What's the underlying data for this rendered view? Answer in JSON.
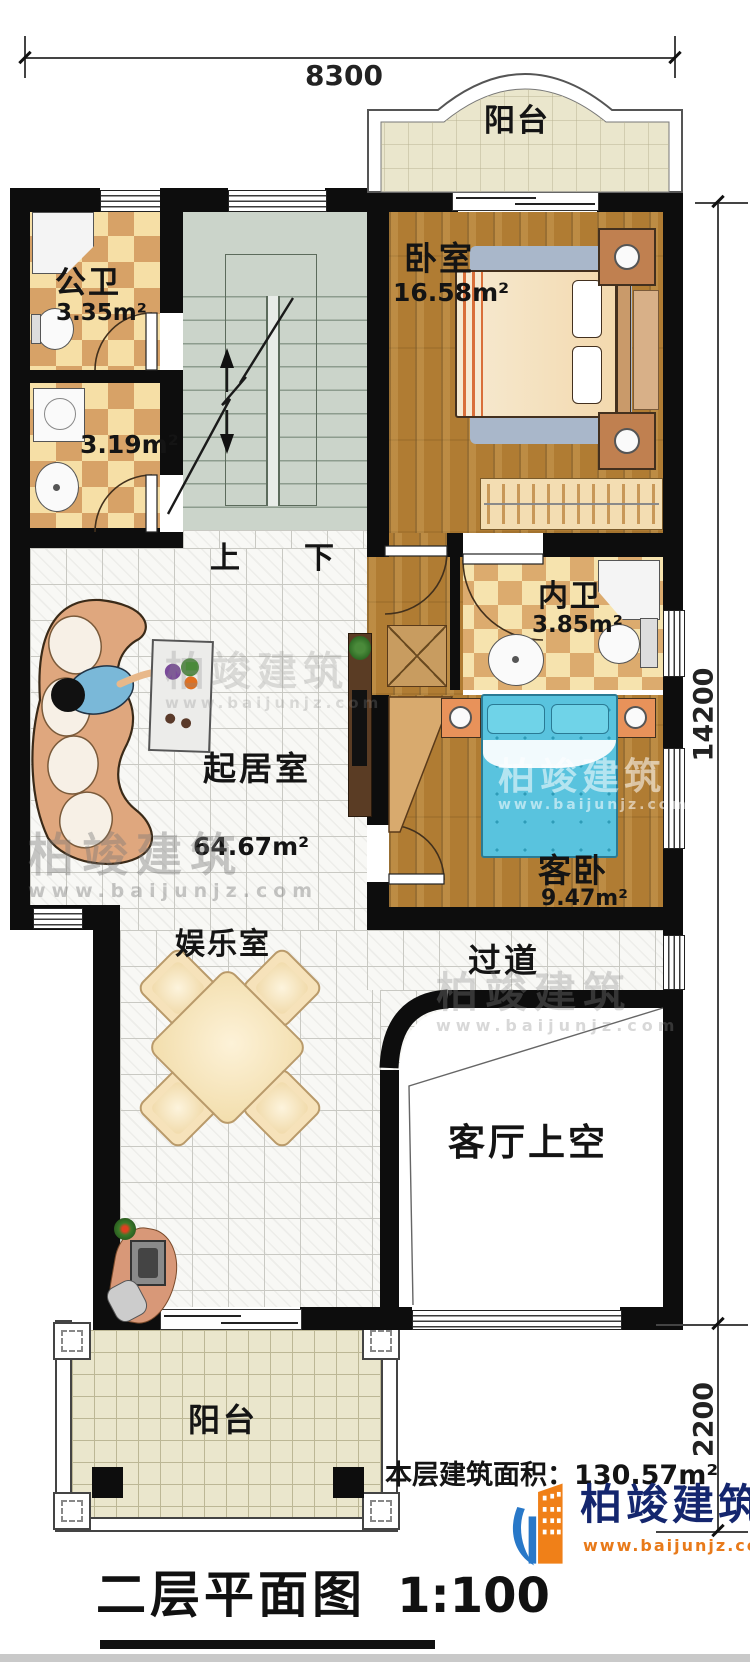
{
  "plan": {
    "type": "floor-plan",
    "floor": "second",
    "drawing_scale": "1:100"
  },
  "rooms": {
    "balcony_top": {
      "name": "阳台"
    },
    "bedroom": {
      "name": "卧室",
      "area": "16.58m²"
    },
    "public_bath": {
      "name": "公卫",
      "area": "3.35m²"
    },
    "laundry_bath": {
      "area": "3.19m²"
    },
    "inner_bath": {
      "name": "内卫",
      "area": "3.85m²"
    },
    "living": {
      "name": "起居室",
      "area": "64.67m²"
    },
    "guest_bedroom": {
      "name": "客卧",
      "area": "9.47m²"
    },
    "entertainment": {
      "name": "娱乐室"
    },
    "corridor": {
      "name": "过道"
    },
    "void_over_hall": {
      "name": "客厅上空"
    },
    "balcony_bottom": {
      "name": "阳台"
    }
  },
  "stairs": {
    "up": "上",
    "down": "下"
  },
  "dimensions": {
    "top_width": "8300",
    "right_main_height": "14200",
    "right_balcony_height": "2200"
  },
  "footer": {
    "area_note": "本层建筑面积：130.57m²",
    "title": "二层平面图",
    "scale": "1:100"
  },
  "brand": {
    "name": "柏竣建筑",
    "url": "www.baijunjz.com"
  },
  "colors": {
    "wall": "#0d0d0d",
    "wood_floor": "#b07c33",
    "bath_checker_dark": "#d7a267",
    "bath_checker_light": "#f6dfa6",
    "balcony_tile": "#eae6cc",
    "stair_floor": "#cbd4ca",
    "guest_bed": "#59c3de",
    "sofa": "#dfa77e",
    "brand_blue": "#14266e",
    "brand_orange": "#e87a1a"
  }
}
